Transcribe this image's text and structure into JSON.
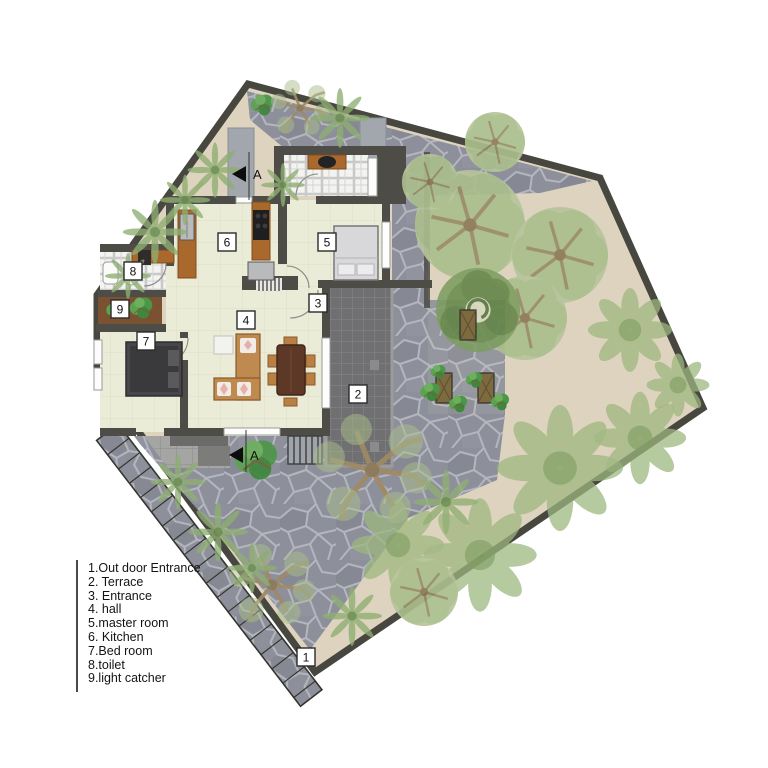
{
  "plan": {
    "section_marker_label": "A",
    "rooms": [
      {
        "number": "1",
        "name": "Out door Entrance"
      },
      {
        "number": "2",
        "name": "Terrace"
      },
      {
        "number": "3",
        "name": "Entrance"
      },
      {
        "number": "4",
        "name": "hall"
      },
      {
        "number": "5",
        "name": "master room"
      },
      {
        "number": "6",
        "name": "Kitchen"
      },
      {
        "number": "7",
        "name": "Bed room"
      },
      {
        "number": "8",
        "name": "toilet"
      },
      {
        "number": "9",
        "name": "light catcher"
      }
    ],
    "legend_items": [
      "1.Out door Entrance",
      "2. Terrace",
      "3. Entrance",
      "4. hall",
      "5.master room",
      "6. Kitchen",
      "7.Bed room",
      "8.toilet",
      "9.light catcher"
    ],
    "colors": {
      "site_border": "#474740",
      "garden_ground": "#ded3be",
      "stone_paving": "#8d909a",
      "terrace_tile": "#707072",
      "wall": "#4d4c46",
      "interior_floor": "#ebecd7",
      "wood": "#a9682c",
      "foliage_light": "#a9bd8b",
      "foliage_dark": "#6e9052",
      "plant_bright": "#4c9648"
    }
  }
}
